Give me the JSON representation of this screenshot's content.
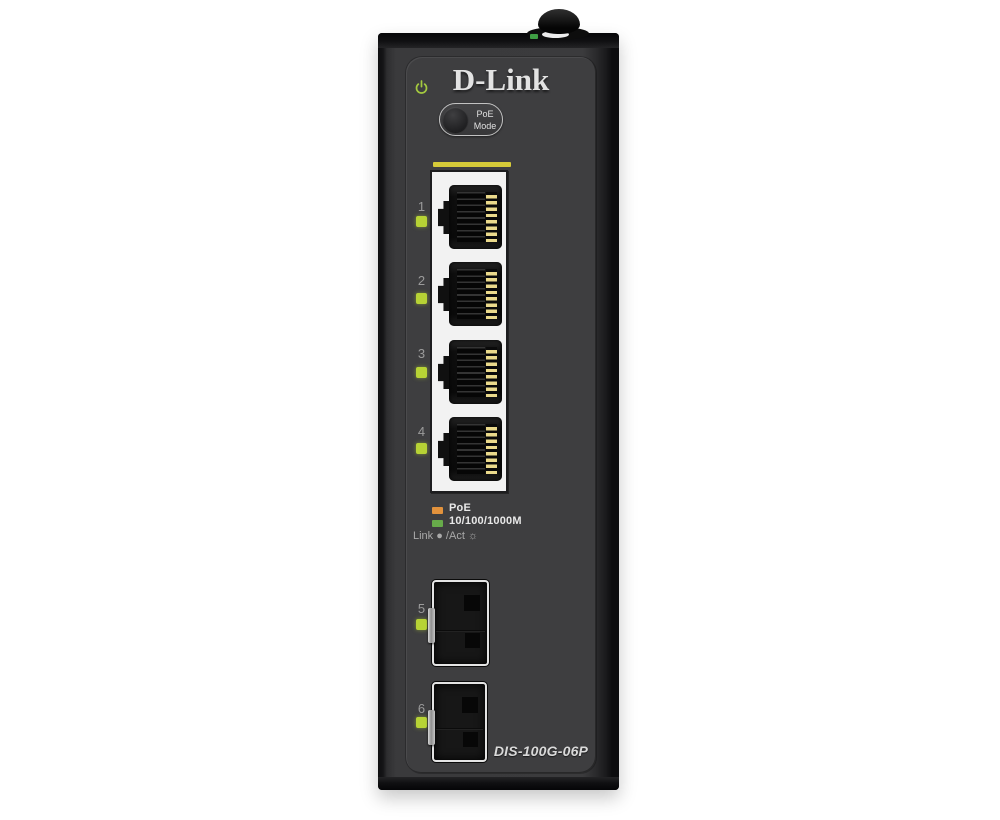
{
  "device": {
    "brand": "D-Link",
    "model": "DIS-100G-06P",
    "power_led_color": "#a4c93f",
    "port_led_color": "#b7d335",
    "poe_mode_button": {
      "line1": "PoE",
      "line2": "Mode"
    },
    "ports": [
      {
        "label": "1",
        "type": "rj45"
      },
      {
        "label": "2",
        "type": "rj45"
      },
      {
        "label": "3",
        "type": "rj45"
      },
      {
        "label": "4",
        "type": "rj45"
      },
      {
        "label": "5",
        "type": "sfp"
      },
      {
        "label": "6",
        "type": "sfp"
      }
    ],
    "legend": [
      {
        "label": "PoE",
        "color": "#e2923c"
      },
      {
        "label": "10/100/1000M",
        "color": "#67ab4a"
      }
    ],
    "link_act_label": "Link ● /Act ☼"
  }
}
